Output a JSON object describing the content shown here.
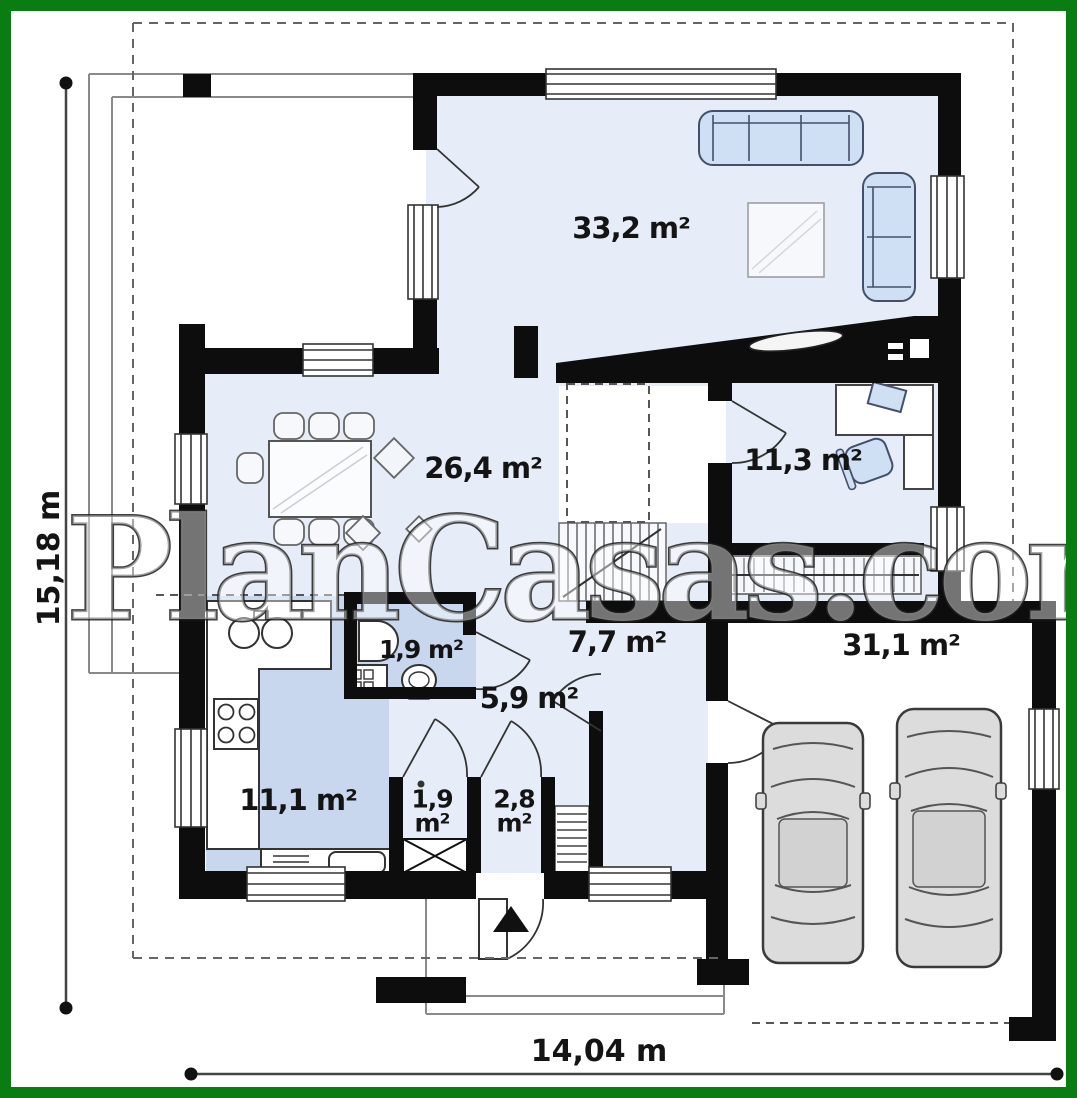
{
  "watermark": "PlanCasas.com",
  "dimensions": {
    "height_label": "15,18 m",
    "width_label": "14,04 m"
  },
  "rooms": {
    "living": {
      "name": "living-room",
      "area": "33,2 m²"
    },
    "dining": {
      "name": "dining-room",
      "area": "26,4 m²"
    },
    "office": {
      "name": "office",
      "area": "11,3 m²"
    },
    "wc": {
      "name": "wc",
      "area": "1,9 m²"
    },
    "hall": {
      "name": "hall",
      "area": "5,9 m²"
    },
    "vestibule": {
      "name": "vestibule",
      "area": "7,7 m²"
    },
    "kitchen": {
      "name": "kitchen",
      "area": "11,1 m²"
    },
    "closet": {
      "name": "closet",
      "area": "1,9\nm²"
    },
    "pantry": {
      "name": "pantry",
      "area": "2,8\nm²"
    },
    "garage": {
      "name": "garage",
      "area": "31,1 m²"
    }
  },
  "furniture": [
    "sofa-3-seat",
    "sofa-2-seat",
    "rug",
    "tv-media-wall",
    "dining-table",
    "dining-chairs",
    "decor-diamonds",
    "desk",
    "office-chair",
    "laptop",
    "kitchen-counter",
    "kitchen-sink",
    "cooktop",
    "lower-counter-appliance",
    "washbasin",
    "washing-machine",
    "toilet",
    "wardrobe-rail",
    "stairs",
    "stairs-lower",
    "x-wardrobe",
    "car",
    "car",
    "entrance-arrow"
  ],
  "colors": {
    "frame_green": "#0a7d12",
    "wall_black": "#0d0d0d",
    "floor_light": "#e7edf8",
    "floor_kitchen": "#c8d7ee",
    "furniture_blue": "#cfe0f4",
    "line_gray": "#8a8a8a"
  }
}
